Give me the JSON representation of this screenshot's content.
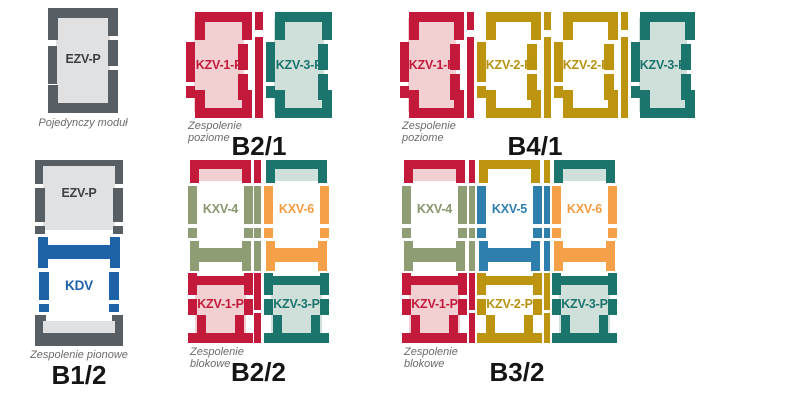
{
  "palette": {
    "red": "#c31a3b",
    "pink": "#f2d0d2",
    "teal": "#1b756d",
    "light_teal": "#cfdfda",
    "gold": "#bd940f",
    "olive": "#8e9d74",
    "orange": "#f5a14a",
    "blue_kdv": "#1e62a8",
    "blue_kxv5": "#2e7fae",
    "gray": "#585f64",
    "light_gray": "#e0e1e3",
    "caption_gray": "#6b6b6b",
    "title_black": "#151515"
  },
  "groups": {
    "single": {
      "caption": "Pojedynczy moduł",
      "module": "EZV-P"
    },
    "b21": {
      "title": "B2/1",
      "caption": "Zespolenie poziome",
      "modules": [
        "KZV-1-P",
        "KZV-3-P"
      ]
    },
    "b41": {
      "title": "B4/1",
      "caption": "Zespolenie poziome",
      "modules": [
        "KZV-1-P",
        "KZV-2-P",
        "KZV-2-P",
        "KZV-3-P"
      ]
    },
    "b12": {
      "title": "B1/2",
      "caption": "Zespolenie pionowe",
      "modules": [
        "EZV-P",
        "KDV"
      ]
    },
    "b22": {
      "title": "B2/2",
      "caption": "Zespolenie blokowe",
      "top_modules": [
        "KXV-4",
        "KXV-6"
      ],
      "bottom_modules": [
        "KZV-1-P",
        "KZV-3-P"
      ]
    },
    "b32": {
      "title": "B3/2",
      "caption": "Zespolenie blokowe",
      "top_modules": [
        "KXV-4",
        "KXV-5",
        "KXV-6"
      ],
      "bottom_modules": [
        "KZV-1-P",
        "KZV-2-P",
        "KZV-3-P"
      ]
    }
  }
}
